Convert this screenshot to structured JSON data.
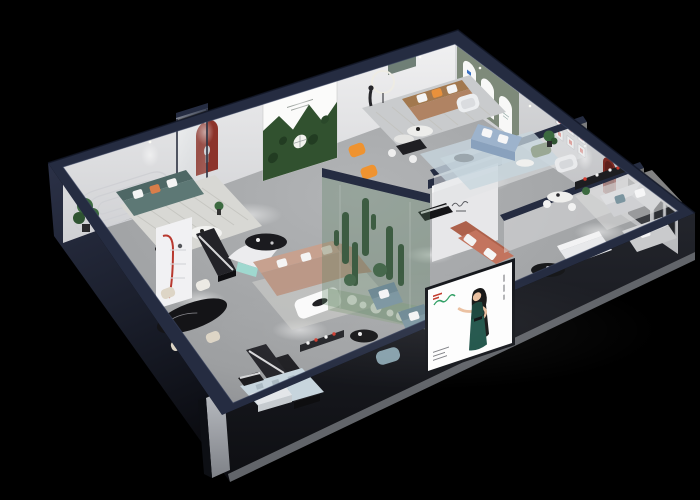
{
  "scene": {
    "background": "#000000",
    "description": "Isometric cutaway 3D render of a furniture showroom with multiple living-room displays, seen from above on a black backdrop"
  },
  "palette": {
    "wallTop": "#252c41",
    "wallTopDeep": "#171d2c",
    "exterior": "#20242f",
    "exteriorDeep": "#0d0f14",
    "slab": "#7b7e84",
    "floor": "#a4a6a8",
    "floorDeep": "#8a8c8f",
    "wallFace": "#ecedee",
    "grayWall": "#d4d5d7",
    "greenWall": "#7e8a7a",
    "forest": "#31512f",
    "teal": "#5d7875",
    "tanLeather": "#b08363",
    "tanFabric": "#bb9887",
    "orange": "#ef9330",
    "terracotta": "#c3745e",
    "blue": "#9db3cc",
    "slate": "#7b95a0",
    "cream": "#ddd5c6",
    "blackFurniture": "#18181b",
    "white": "#f4f4f5",
    "nicheRed": "#8c332a",
    "accentRed": "#cf3a2e",
    "plant": "#3c6a40",
    "glassGreen": "#5d8264",
    "dress": "#174239",
    "skin": "#eabf9e",
    "rug": "#d8d8d4",
    "rugBlue": "#c7d5dd",
    "logoRed": "#c0392b",
    "logoGreen": "#2e9e63"
  },
  "objects": {
    "billboard": "poster-of-woman-in-green-dress",
    "terrarium": "glass-cactus-garden",
    "forest_poster": "forest-photo-poster",
    "arch_posters": "three-arched-wall-posters",
    "niches": "dark-red-arched-wall-niches",
    "gallery": "six-small-framed-pictures"
  }
}
